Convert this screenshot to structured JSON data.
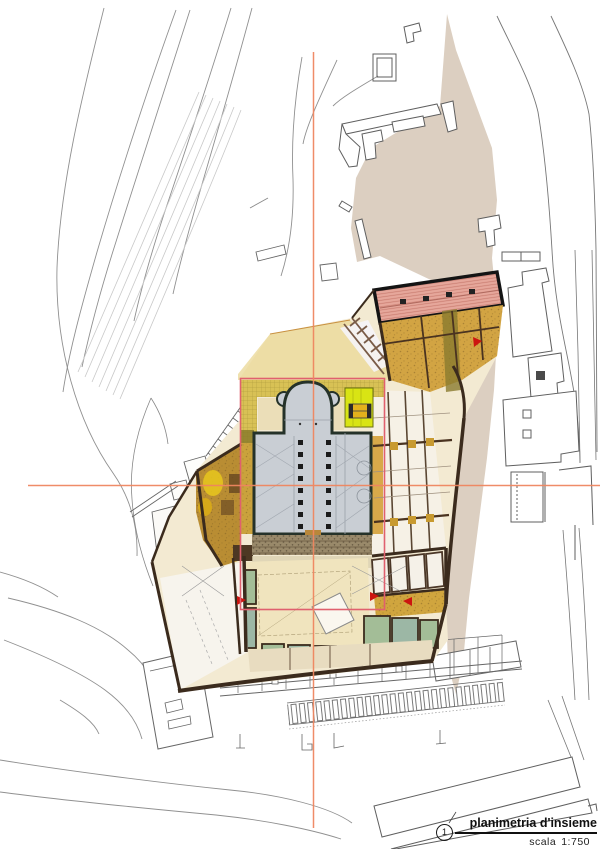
{
  "document": {
    "title": "planimetria d'insieme",
    "drawing_number": "1",
    "scale_label": "scala",
    "scale_value": "1:750"
  },
  "colors": {
    "paper": "#ffffff",
    "contour_line": "#909090",
    "open_space_beige": "#dccfc1",
    "plan_wall_brown": "#3b2b1d",
    "church_fill": "#c9ced4",
    "church_wall": "#253229",
    "ochre_main": "#d2a443",
    "ochre_dark": "#b98d33",
    "pink_block": "#e6a79b",
    "chartreuse_highlight": "#d9e414",
    "courtyard_cream": "#f0e4be",
    "green_room_sage": "#a3bd97",
    "green_room_teal": "#9cb7a5",
    "crosshair": "#ef8660",
    "frame": "#e0606e",
    "marker_red": "#cc1510",
    "ink": "#101010"
  }
}
